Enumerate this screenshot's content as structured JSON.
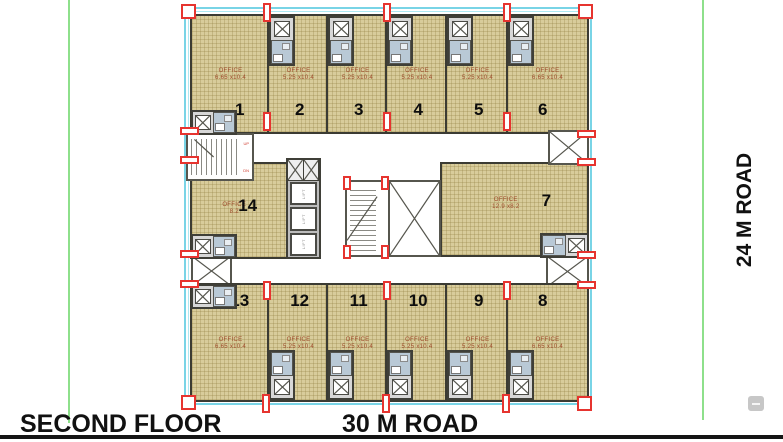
{
  "labels": {
    "floor_title": "SECOND FLOOR",
    "road_bottom": "30 M ROAD",
    "road_right": "24 M ROAD"
  },
  "ui": {
    "zoom_out_glyph": "–"
  },
  "offices": {
    "o1": {
      "num": "1",
      "name": "OFFICE",
      "dims": "6.65 x10.4"
    },
    "o2": {
      "num": "2",
      "name": "OFFICE",
      "dims": "5.25 x10.4"
    },
    "o3": {
      "num": "3",
      "name": "OFFICE",
      "dims": "5.25 x10.4"
    },
    "o4": {
      "num": "4",
      "name": "OFFICE",
      "dims": "5.25 x10.4"
    },
    "o5": {
      "num": "5",
      "name": "OFFICE",
      "dims": "5.25 x10.4"
    },
    "o6": {
      "num": "6",
      "name": "OFFICE",
      "dims": "6.65 x10.4"
    },
    "o7": {
      "num": "7",
      "name": "OFFICE",
      "dims": "12.9 x8.2"
    },
    "o8": {
      "num": "8",
      "name": "OFFICE",
      "dims": "6.65 x10.4"
    },
    "o9": {
      "num": "9",
      "name": "OFFICE",
      "dims": "5.25 x10.4"
    },
    "o10": {
      "num": "10",
      "name": "OFFICE",
      "dims": "5.25 x10.4"
    },
    "o11": {
      "num": "11",
      "name": "OFFICE",
      "dims": "5.25 x10.4"
    },
    "o12": {
      "num": "12",
      "name": "OFFICE",
      "dims": "5.25 x10.4"
    },
    "o13": {
      "num": "13",
      "name": "OFFICE",
      "dims": "6.65 x10.4"
    },
    "o14": {
      "num": "14",
      "name": "OFFICE",
      "dims": "8.2"
    }
  },
  "core": {
    "lift1": "LIFT",
    "lift2": "LIFT",
    "lift3": "LIFT",
    "stair_up": "UP",
    "stair_dn": "DN"
  },
  "colors": {
    "office_fill": "#d8cc9b",
    "plan_outline_cyan": "#79d4e6",
    "registration_red": "#e6342f",
    "dims_text_brown": "#9e4b2b",
    "road_line_green": "#8ee08b"
  }
}
